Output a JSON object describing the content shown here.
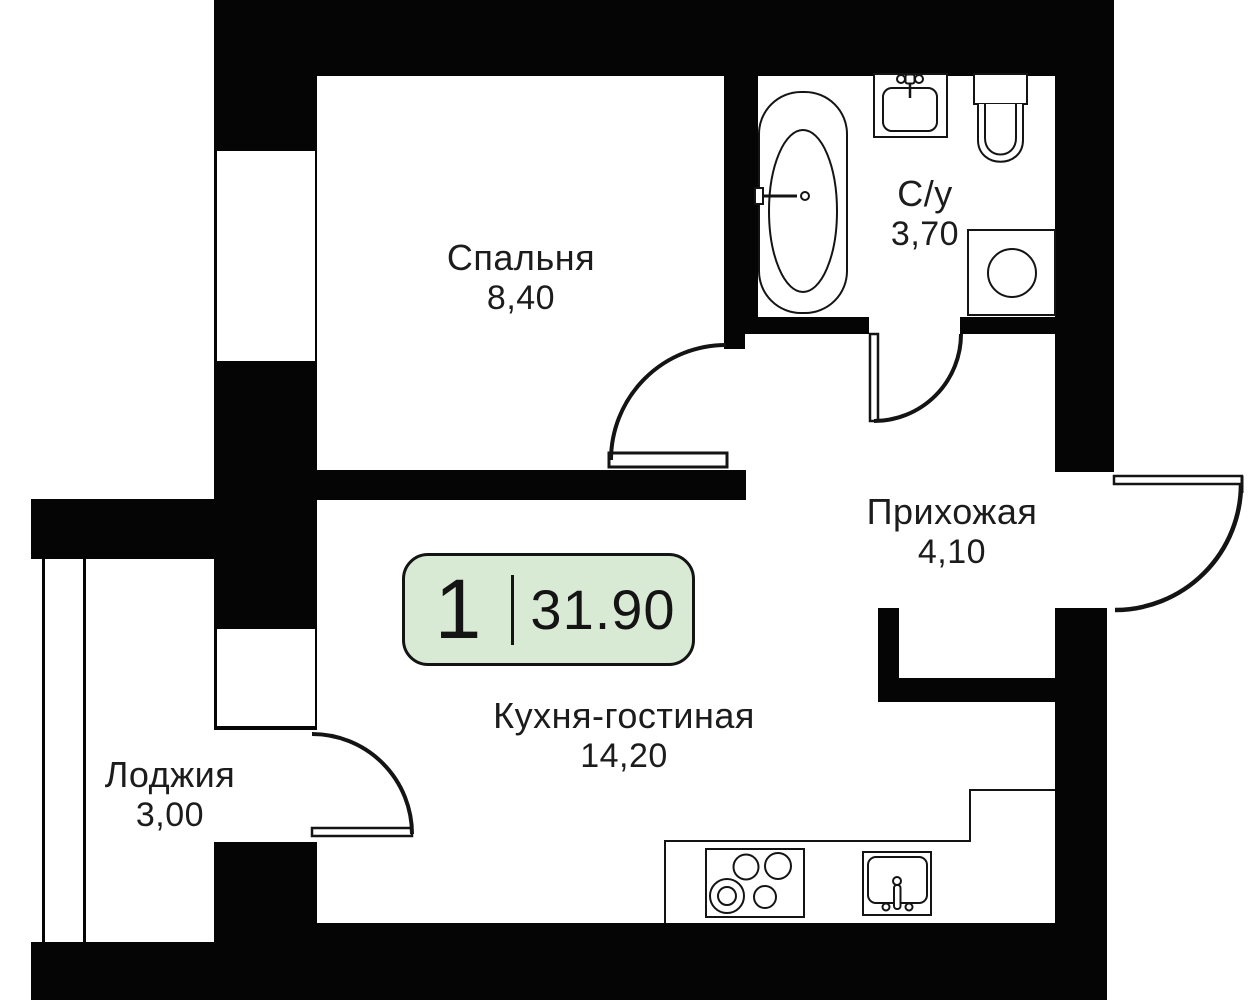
{
  "plan": {
    "title": "apartment-floor-plan",
    "colors": {
      "background": "#ffffff",
      "walls": "#050505",
      "lines": "#141414",
      "text": "#1c1c1c",
      "badge_fill": "#d8e9d4"
    },
    "badge": {
      "rooms_count": "1",
      "area_value": "31.90"
    },
    "rooms": [
      {
        "id": "bedroom",
        "label": "Спальня",
        "area": "8,40"
      },
      {
        "id": "bathroom",
        "label": "С/у",
        "area": "3,70"
      },
      {
        "id": "hallway",
        "label": "Прихожая",
        "area": "4,10"
      },
      {
        "id": "kitchen-living",
        "label": "Кухня-гостиная",
        "area": "14,20"
      },
      {
        "id": "loggia",
        "label": "Лоджия",
        "area": "3,00"
      }
    ],
    "fixtures": [
      "bathtub",
      "bathroom-sink",
      "toilet",
      "washing-machine",
      "kitchen-counter",
      "stove",
      "kitchen-sink"
    ],
    "doors": [
      "bedroom-door",
      "bathroom-door",
      "entrance-door",
      "balcony-door"
    ],
    "windows": [
      "bedroom-window",
      "wall-shaft-window",
      "loggia-glazing"
    ]
  }
}
